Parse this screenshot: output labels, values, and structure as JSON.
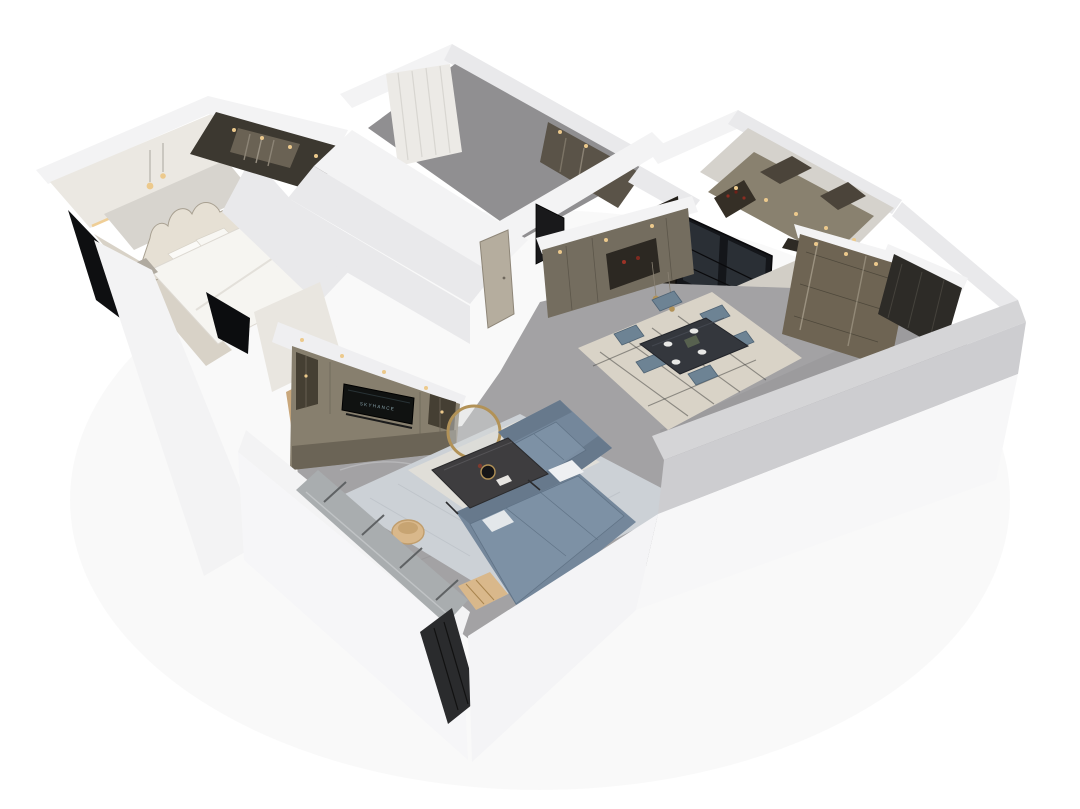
{
  "scene": {
    "type": "isometric-3d-floorplan-render",
    "description": "Dollhouse-style 3D render of a modern apartment interior viewed from above on a white background",
    "tv": {
      "brand_text": "SKYHANCE"
    },
    "rooms": [
      {
        "name": "master-bedroom",
        "items": [
          "double-bed",
          "tufted-headboard",
          "pillows",
          "nightstands",
          "pendant-lamps",
          "cove-lighting",
          "dark-balcony-glazing"
        ]
      },
      {
        "name": "walk-in-closet",
        "items": [
          "wardrobe-shelving",
          "hanging-clothes",
          "ceiling-downlights"
        ]
      },
      {
        "name": "second-bedroom",
        "items": [
          "sheer-curtains",
          "built-in-wardrobe",
          "gray-floor"
        ]
      },
      {
        "name": "kitchen",
        "items": [
          "upper-cabinets",
          "wine-shelf",
          "counter",
          "black-framed-glass-partition",
          "ceiling-downlights"
        ]
      },
      {
        "name": "hallway",
        "items": [
          "interior-door",
          "dark-mirror-panel"
        ]
      },
      {
        "name": "dining-room",
        "items": [
          "dark-dining-table",
          "dining-chairs-x6",
          "tableware",
          "patterned-rug",
          "gold-pendant-lights",
          "sideboard-cabinet"
        ]
      },
      {
        "name": "entry-hall",
        "items": [
          "display-cabinet",
          "dark-entry-door",
          "marble-floor"
        ]
      },
      {
        "name": "living-room",
        "items": [
          "l-shaped-sectional-sofa",
          "marble-coffee-table",
          "gold-ring-side-table",
          "rattan-basket",
          "wood-slat-side-table",
          "tv-media-wall",
          "area-rug",
          "floor-to-ceiling-windows"
        ]
      }
    ]
  },
  "colors": {
    "background": "#ffffff",
    "wall_white": "#f3f3f4",
    "wall_shade": "#e9e9eb",
    "wall_gray": "#d5d5d7",
    "wall_mid": "#cdcdd0",
    "bedroom_wall": "#ebe8e2",
    "floor_marble": "#a3a2a4",
    "floor_entry": "#d2cec6",
    "floor_bedroom2": "#908f91",
    "floor_wood": "#d8d2c7",
    "ceiling_kitchen": "#d5d2cc",
    "cabinet_taupe": "#877f6e",
    "cabinet_dark": "#453f33",
    "sideboard": "#746d5f",
    "kitchen_cabinet": "#89816f",
    "entry_cabinet": "#6e6453",
    "wardrobe_dark": "#5a5348",
    "closet_dark": "#3c3830",
    "tv_black": "#101211",
    "glass_dark": "#14161a",
    "window_glass": "#a9adaf",
    "sofa_blue": "#74879b",
    "sofa_shade": "#67798c",
    "chair_blue": "#6d8394",
    "table_dark": "#34373d",
    "coffee_table": "#3e3d3f",
    "rug_living": "#ccd1d6",
    "rug_dining": "#d9d3c7",
    "gold": "#b29257",
    "warm_light": "#ecc98c",
    "tan": "#d9b88b",
    "door_beige": "#b5ad9e",
    "door_dark": "#2d2b27",
    "headboard": "#e6e0d4",
    "bed_white": "#f6f5f1"
  }
}
